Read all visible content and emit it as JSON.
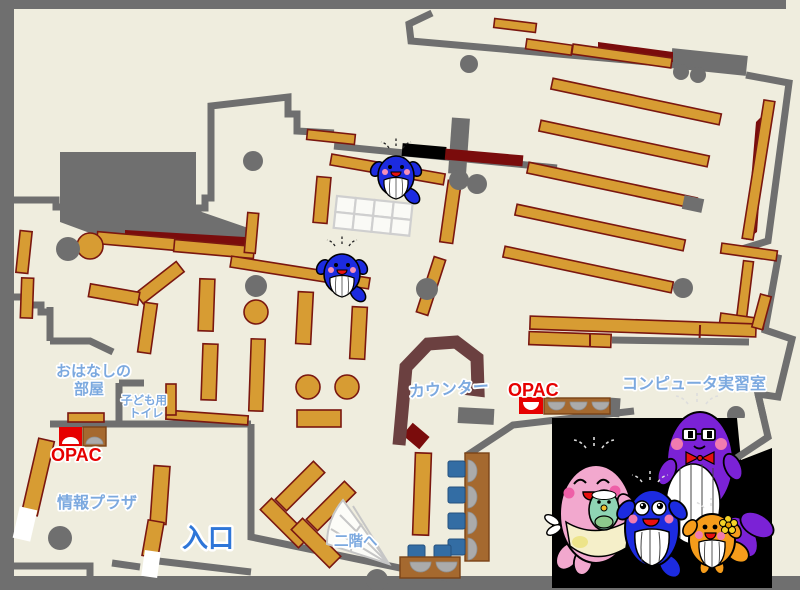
{
  "map": {
    "labels": {
      "story_room_l1": "おはなしの",
      "story_room_l2": "部屋",
      "kids_toilet_l1": "子ども用",
      "kids_toilet_l2": "トイレ",
      "opac_left": "OPAC",
      "info_plaza": "情報プラザ",
      "entrance": "入口",
      "counter": "カウンター",
      "opac_right": "OPAC",
      "computer_room": "コンピュータ実習室",
      "stairs_up": "二階へ"
    },
    "colors": {
      "floor": "#EFEDDE",
      "wall": "#6F6F6F",
      "shelf": "#D79C33",
      "shelf_stroke": "#7A1710",
      "dark_red": "#7A0C0C",
      "counter": "#6B4040",
      "desk_brown": "#A5692F",
      "chair_blue": "#336DA4",
      "dish_gray": "#ABABAB",
      "label_blue": "#7CA9DF",
      "entrance_blue": "#2E76D8",
      "opac_red": "#E60000",
      "mascot_blue": "#1C2BE0",
      "mascot_pink": "#F2A8CE",
      "mascot_purple": "#7B22D6",
      "mascot_orange": "#F59C1B",
      "mascot_teal": "#8FD4B4"
    },
    "mascots": [
      "whale-mascot-small-upper",
      "whale-mascot-small-lower",
      "mama-whale",
      "baby-whale",
      "blue-kid-whale",
      "papa-whale",
      "orange-kid-whale"
    ]
  }
}
